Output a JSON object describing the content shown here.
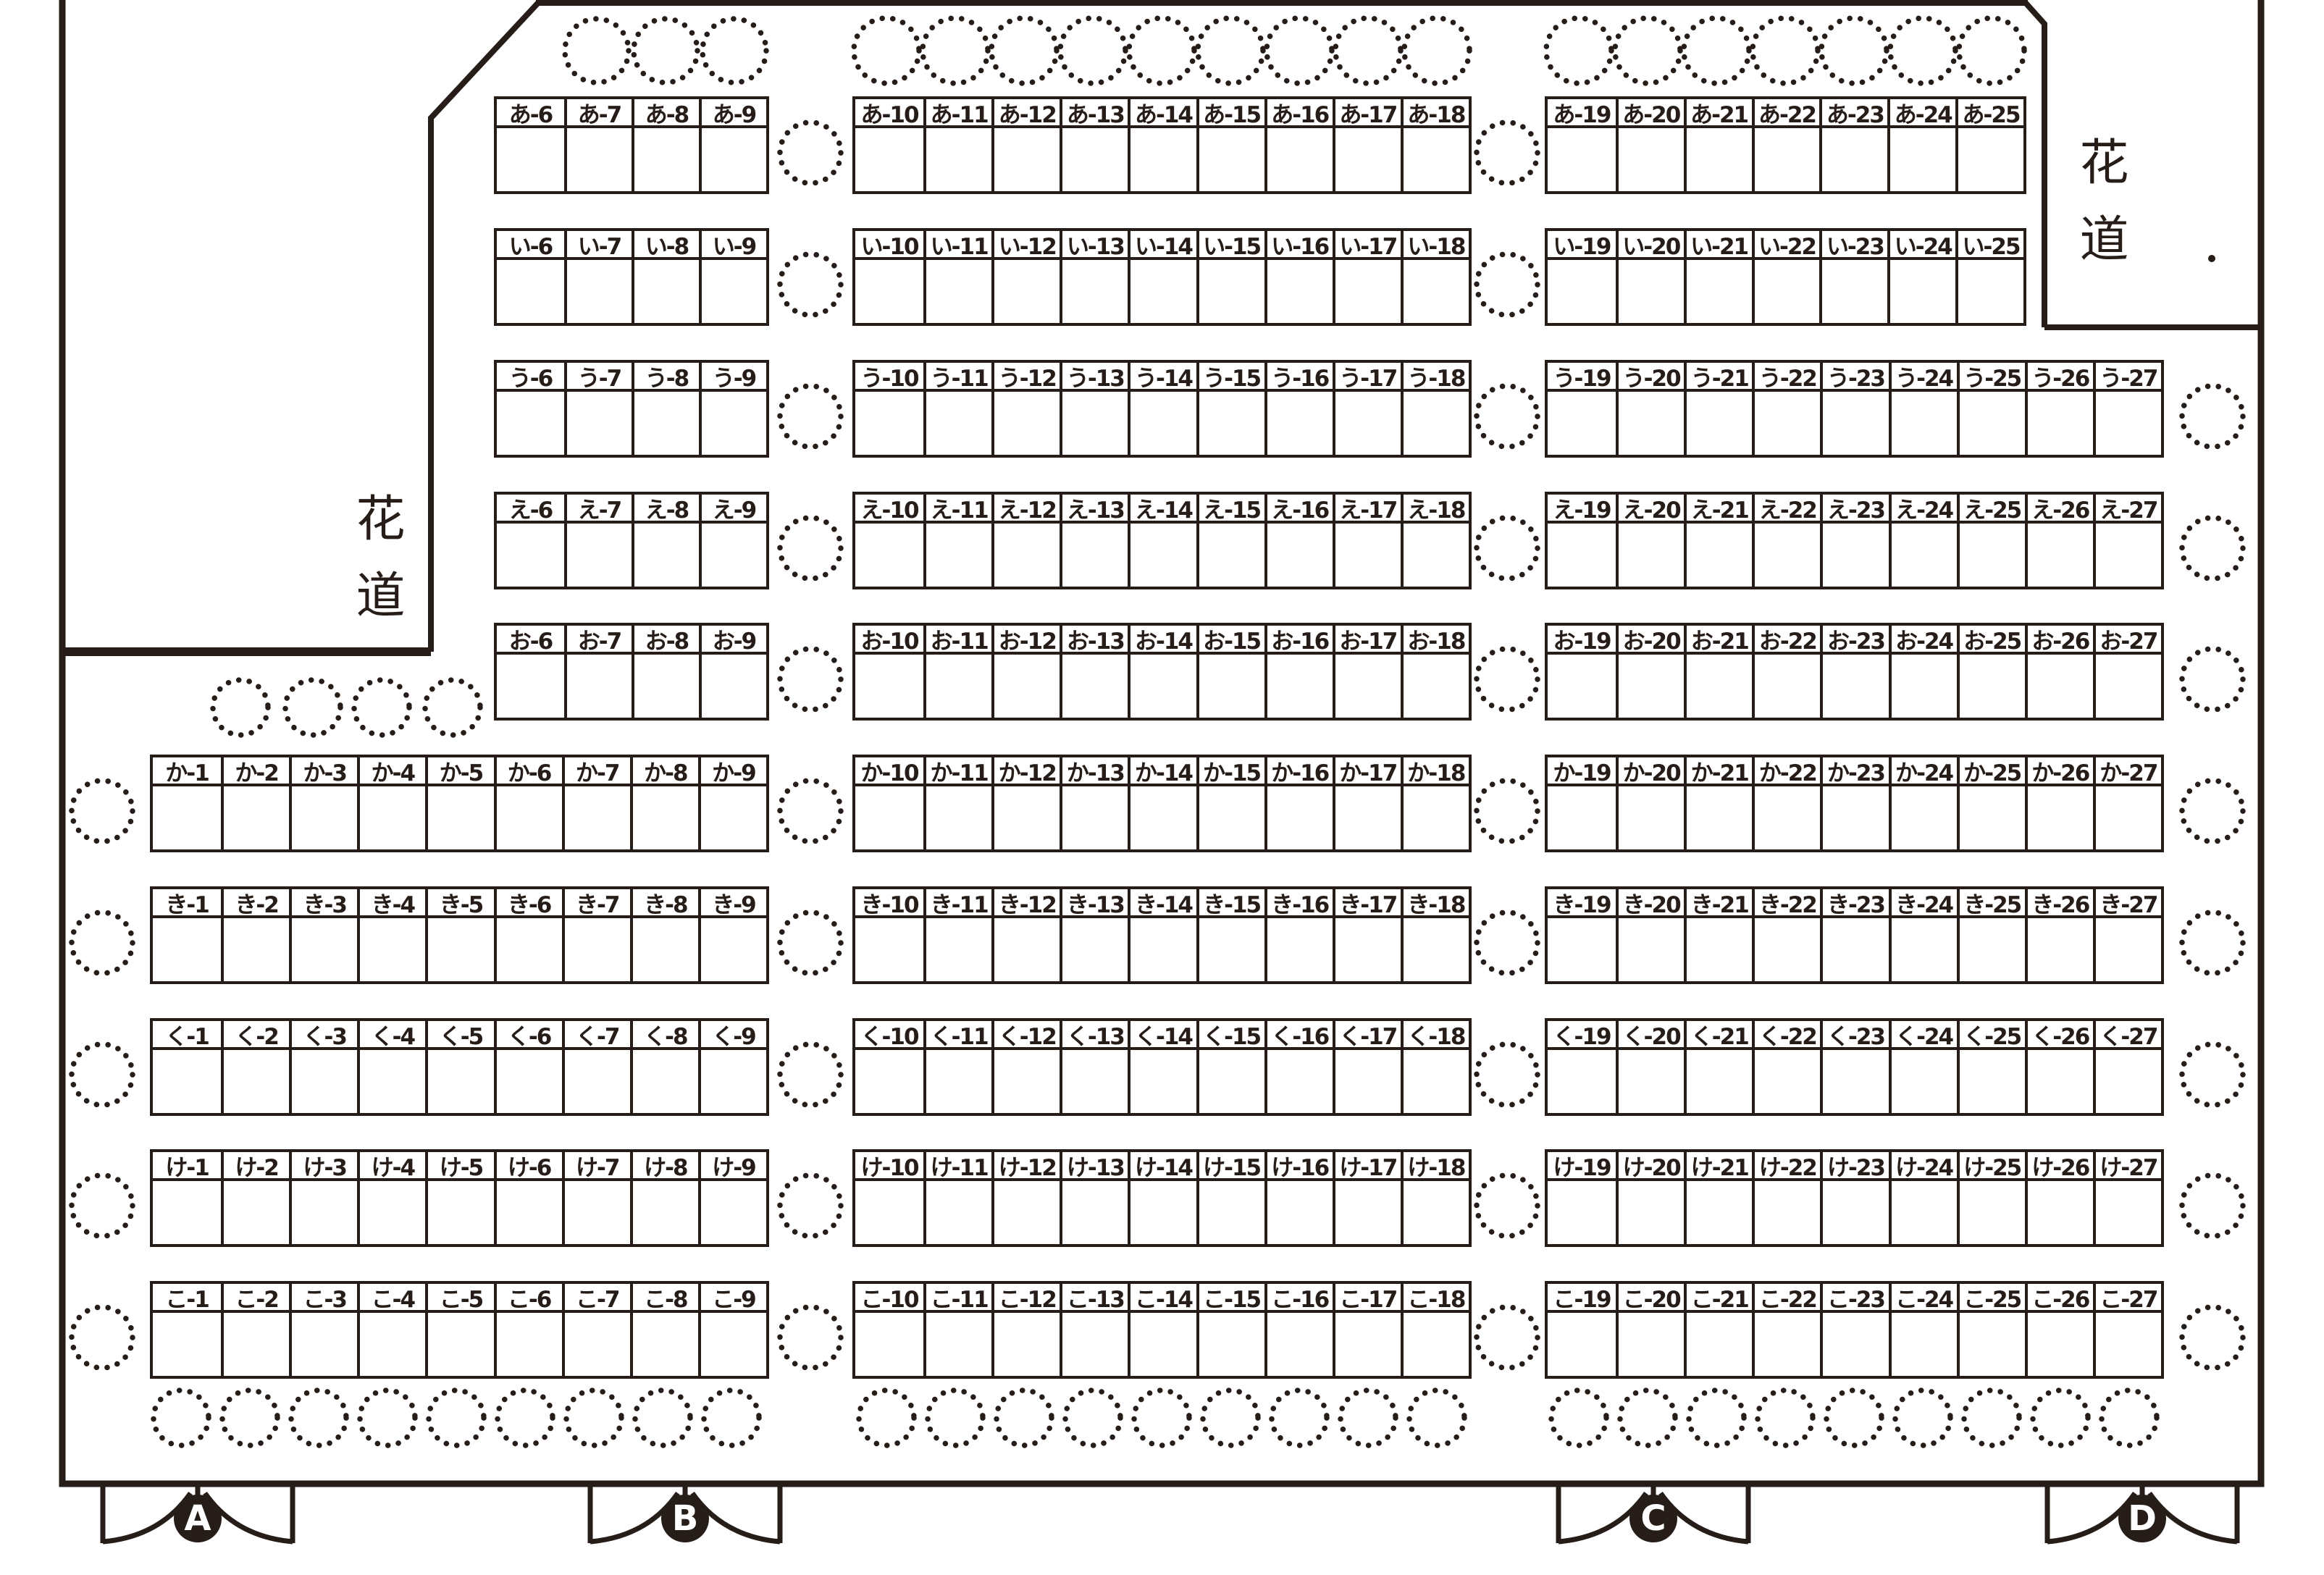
{
  "venue": {
    "hanamichi_left": "花道",
    "hanamichi_right": "花道",
    "doors": [
      {
        "label": "A"
      },
      {
        "label": "B"
      },
      {
        "label": "C"
      },
      {
        "label": "D"
      }
    ],
    "ink_color": "#261d18",
    "rows": [
      {
        "kana": "あ",
        "blocks": [
          {
            "seats": [
              "あ-6",
              "あ-7",
              "あ-8",
              "あ-9"
            ]
          },
          {
            "seats": [
              "あ-10",
              "あ-11",
              "あ-12",
              "あ-13",
              "あ-14",
              "あ-15",
              "あ-16",
              "あ-17",
              "あ-18"
            ]
          },
          {
            "seats": [
              "あ-19",
              "あ-20",
              "あ-21",
              "あ-22",
              "あ-23",
              "あ-24",
              "あ-25"
            ]
          }
        ]
      },
      {
        "kana": "い",
        "blocks": [
          {
            "seats": [
              "い-6",
              "い-7",
              "い-8",
              "い-9"
            ]
          },
          {
            "seats": [
              "い-10",
              "い-11",
              "い-12",
              "い-13",
              "い-14",
              "い-15",
              "い-16",
              "い-17",
              "い-18"
            ]
          },
          {
            "seats": [
              "い-19",
              "い-20",
              "い-21",
              "い-22",
              "い-23",
              "い-24",
              "い-25"
            ]
          }
        ]
      },
      {
        "kana": "う",
        "blocks": [
          {
            "seats": [
              "う-6",
              "う-7",
              "う-8",
              "う-9"
            ]
          },
          {
            "seats": [
              "う-10",
              "う-11",
              "う-12",
              "う-13",
              "う-14",
              "う-15",
              "う-16",
              "う-17",
              "う-18"
            ]
          },
          {
            "seats": [
              "う-19",
              "う-20",
              "う-21",
              "う-22",
              "う-23",
              "う-24",
              "う-25",
              "う-26",
              "う-27"
            ]
          }
        ]
      },
      {
        "kana": "え",
        "blocks": [
          {
            "seats": [
              "え-6",
              "え-7",
              "え-8",
              "え-9"
            ]
          },
          {
            "seats": [
              "え-10",
              "え-11",
              "え-12",
              "え-13",
              "え-14",
              "え-15",
              "え-16",
              "え-17",
              "え-18"
            ]
          },
          {
            "seats": [
              "え-19",
              "え-20",
              "え-21",
              "え-22",
              "え-23",
              "え-24",
              "え-25",
              "え-26",
              "え-27"
            ]
          }
        ]
      },
      {
        "kana": "お",
        "blocks": [
          {
            "seats": [
              "お-6",
              "お-7",
              "お-8",
              "お-9"
            ]
          },
          {
            "seats": [
              "お-10",
              "お-11",
              "お-12",
              "お-13",
              "お-14",
              "お-15",
              "お-16",
              "お-17",
              "お-18"
            ]
          },
          {
            "seats": [
              "お-19",
              "お-20",
              "お-21",
              "お-22",
              "お-23",
              "お-24",
              "お-25",
              "お-26",
              "お-27"
            ]
          }
        ]
      },
      {
        "kana": "か",
        "blocks": [
          {
            "seats": [
              "か-1",
              "か-2",
              "か-3",
              "か-4",
              "か-5",
              "か-6",
              "か-7",
              "か-8",
              "か-9"
            ]
          },
          {
            "seats": [
              "か-10",
              "か-11",
              "か-12",
              "か-13",
              "か-14",
              "か-15",
              "か-16",
              "か-17",
              "か-18"
            ]
          },
          {
            "seats": [
              "か-19",
              "か-20",
              "か-21",
              "か-22",
              "か-23",
              "か-24",
              "か-25",
              "か-26",
              "か-27"
            ]
          }
        ]
      },
      {
        "kana": "き",
        "blocks": [
          {
            "seats": [
              "き-1",
              "き-2",
              "き-3",
              "き-4",
              "き-5",
              "き-6",
              "き-7",
              "き-8",
              "き-9"
            ]
          },
          {
            "seats": [
              "き-10",
              "き-11",
              "き-12",
              "き-13",
              "き-14",
              "き-15",
              "き-16",
              "き-17",
              "き-18"
            ]
          },
          {
            "seats": [
              "き-19",
              "き-20",
              "き-21",
              "き-22",
              "き-23",
              "き-24",
              "き-25",
              "き-26",
              "き-27"
            ]
          }
        ]
      },
      {
        "kana": "く",
        "blocks": [
          {
            "seats": [
              "く-1",
              "く-2",
              "く-3",
              "く-4",
              "く-5",
              "く-6",
              "く-7",
              "く-8",
              "く-9"
            ]
          },
          {
            "seats": [
              "く-10",
              "く-11",
              "く-12",
              "く-13",
              "く-14",
              "く-15",
              "く-16",
              "く-17",
              "く-18"
            ]
          },
          {
            "seats": [
              "く-19",
              "く-20",
              "く-21",
              "く-22",
              "く-23",
              "く-24",
              "く-25",
              "く-26",
              "く-27"
            ]
          }
        ]
      },
      {
        "kana": "け",
        "blocks": [
          {
            "seats": [
              "け-1",
              "け-2",
              "け-3",
              "け-4",
              "け-5",
              "け-6",
              "け-7",
              "け-8",
              "け-9"
            ]
          },
          {
            "seats": [
              "け-10",
              "け-11",
              "け-12",
              "け-13",
              "け-14",
              "け-15",
              "け-16",
              "け-17",
              "け-18"
            ]
          },
          {
            "seats": [
              "け-19",
              "け-20",
              "け-21",
              "け-22",
              "け-23",
              "け-24",
              "け-25",
              "け-26",
              "け-27"
            ]
          }
        ]
      },
      {
        "kana": "こ",
        "blocks": [
          {
            "seats": [
              "こ-1",
              "こ-2",
              "こ-3",
              "こ-4",
              "こ-5",
              "こ-6",
              "こ-7",
              "こ-8",
              "こ-9"
            ]
          },
          {
            "seats": [
              "こ-10",
              "こ-11",
              "こ-12",
              "こ-13",
              "こ-14",
              "こ-15",
              "こ-16",
              "こ-17",
              "こ-18"
            ]
          },
          {
            "seats": [
              "こ-19",
              "こ-20",
              "こ-21",
              "こ-22",
              "こ-23",
              "こ-24",
              "こ-25",
              "こ-26",
              "こ-27"
            ]
          }
        ]
      }
    ]
  }
}
